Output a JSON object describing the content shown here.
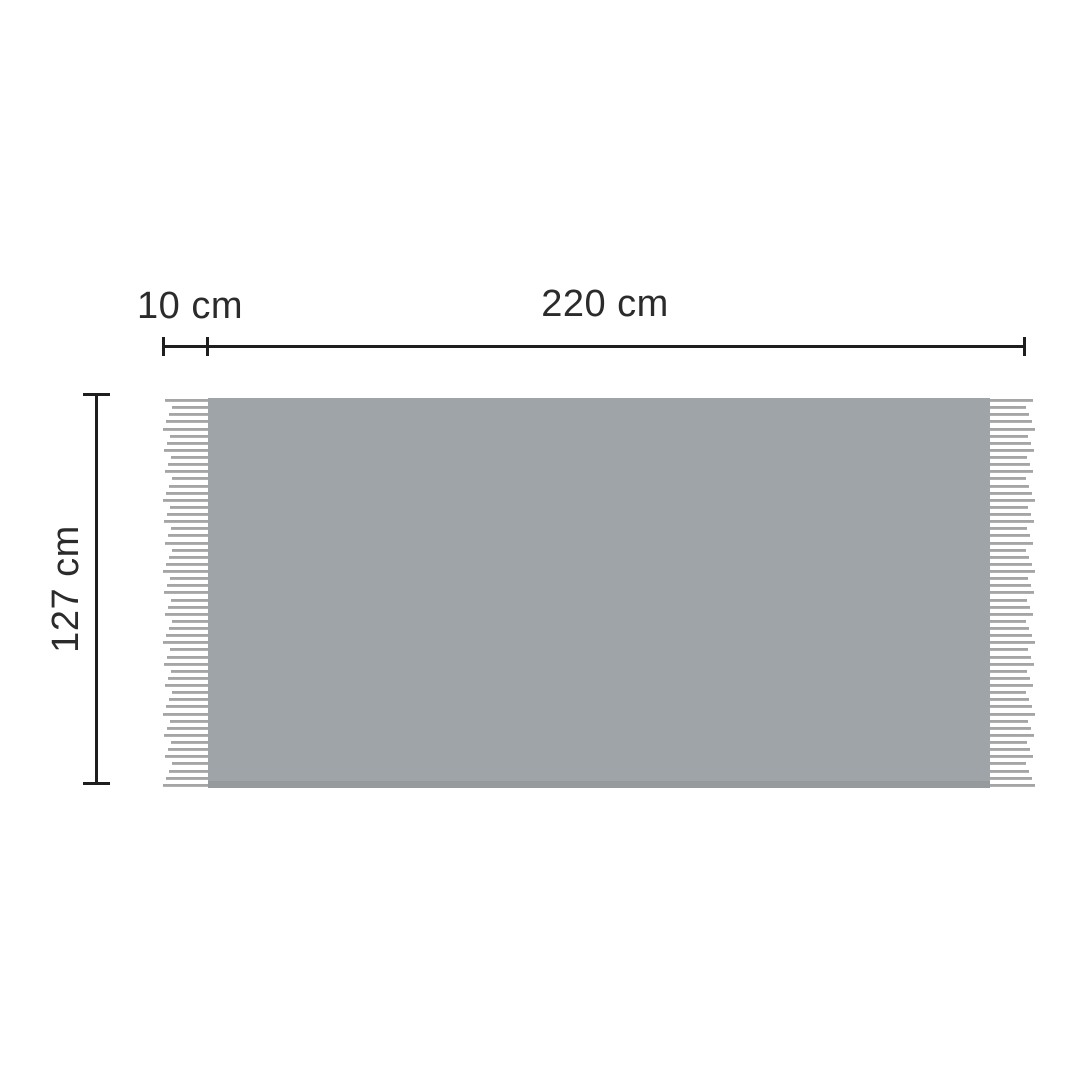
{
  "diagram": {
    "subject": "blanket-with-fringe-dimension-diagram",
    "labels": {
      "fringe_width": "10 cm",
      "body_width": "220 cm",
      "height": "127 cm"
    },
    "fringe": {
      "strand_count": 55,
      "sides": [
        "left",
        "right"
      ]
    },
    "colors": {
      "background": "#ffffff",
      "blanket_fill": "#9ea4a7",
      "blanket_edge": "#959a9d",
      "fringe_strand": "#a5a5a5",
      "fringe_strand_light": "#bdbdbd",
      "dimension_line": "#1e1e1e",
      "label_text": "#2b2b2b"
    }
  }
}
